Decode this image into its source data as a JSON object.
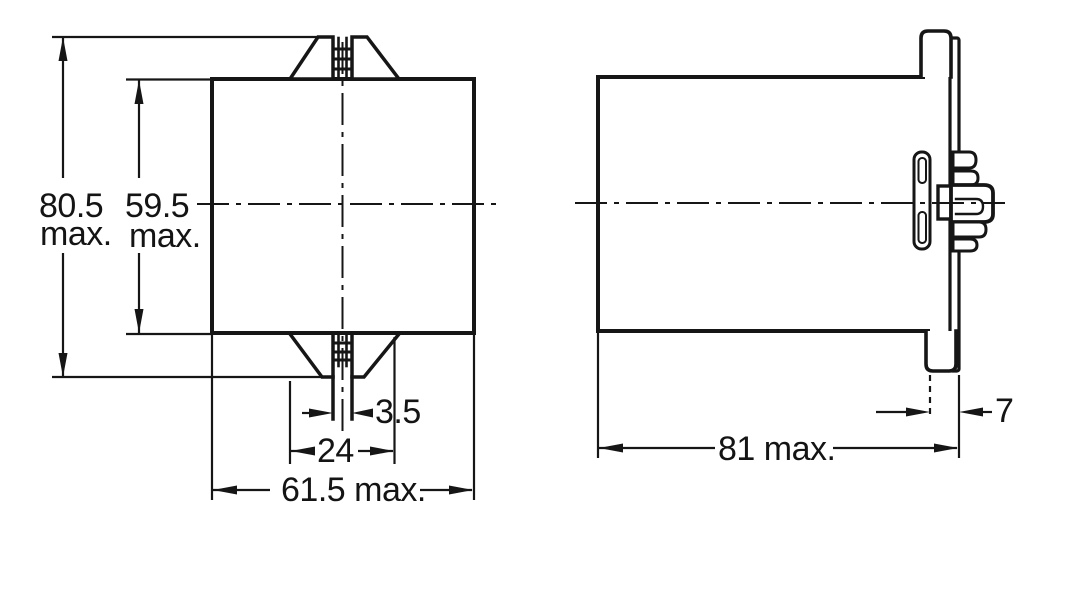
{
  "drawing": {
    "kind": "mechanical-outline-two-views",
    "colors": {
      "line": "#161616",
      "background": "#ffffff"
    }
  },
  "dimensions": {
    "overall_height_value": "80.5",
    "overall_height_suffix": "max.",
    "body_height_value": "59.5",
    "body_height_suffix": "max.",
    "latch_slot_width": "3.5",
    "mounting_clip_width": "24",
    "overall_width": "61.5 max.",
    "overall_depth": "81 max.",
    "rear_flange_depth": "7"
  }
}
